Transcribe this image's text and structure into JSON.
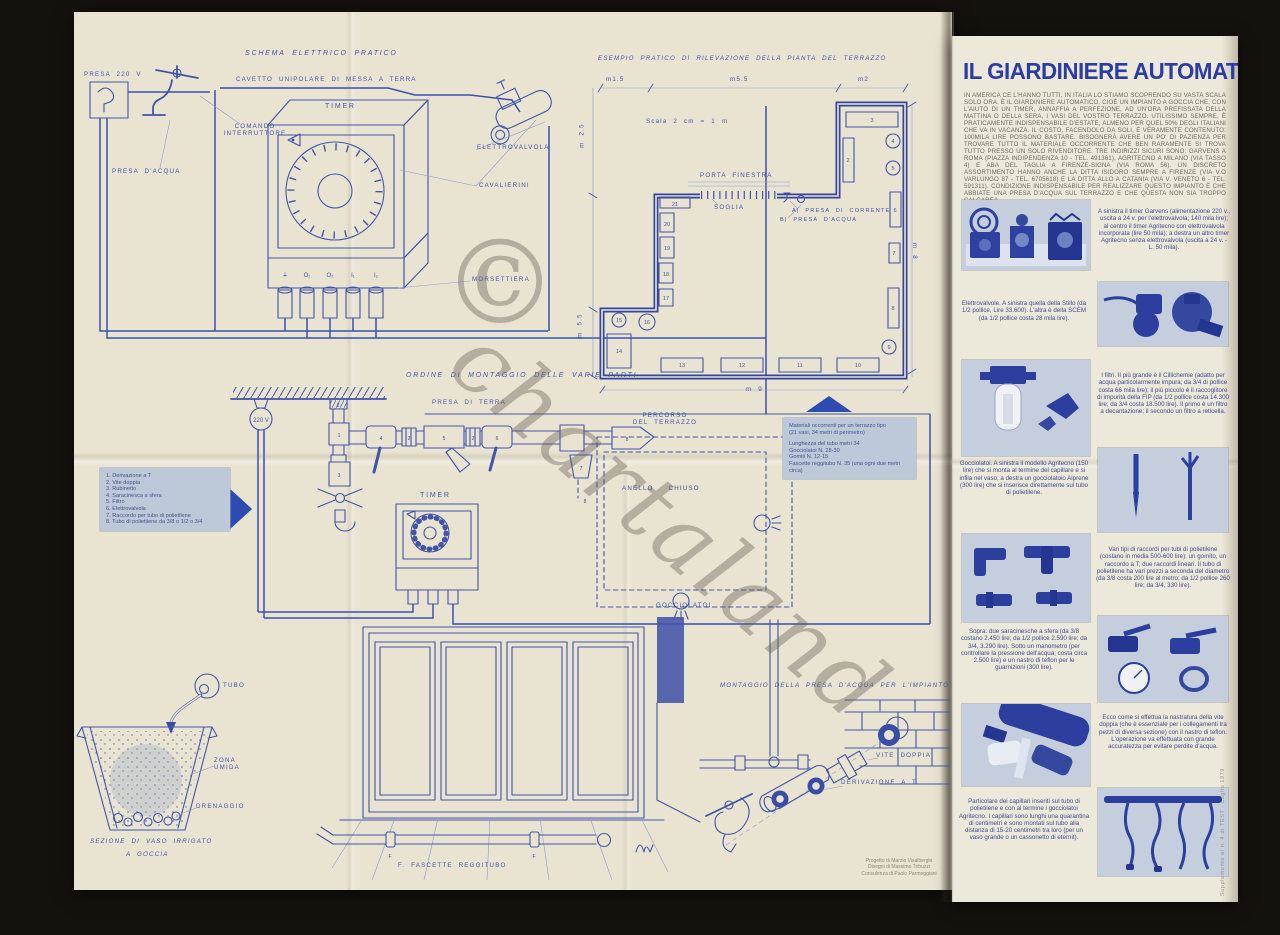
{
  "colors": {
    "ink": "#4254a8",
    "ink_dark": "#2b3da5",
    "paper": "#e9e4d2",
    "paper_right": "#ece8da",
    "photo_bg": "#c5cedd",
    "box_bg": "#bdc9d9"
  },
  "watermark": {
    "symbol": "©",
    "text": "chartaland"
  },
  "edge_note": "Supplemento al n. 4 di TEST - Luglio 1979",
  "credits": {
    "line1": "Progetto di Marzio Visalberghi",
    "line2": "Disegni di Massimo Tribuzzi",
    "line3": "Consulenza di Paolo Parmeggiani"
  },
  "schema": {
    "title": "SCHEMA ELETTRICO PRATICO",
    "presa_220": "PRESA 220 V",
    "cavetto": "CAVETTO UNIPOLARE DI MESSA A TERRA",
    "timer": "TIMER",
    "comando_1": "COMANDO",
    "comando_2": "INTERRUTTORE",
    "presa_acqua": "PRESA D'ACQUA",
    "elettrovalvola": "ELETTROVALVOLA",
    "cavalierini": "CAVALIERINI",
    "morsettiera": "MORSETTIERA",
    "terminals": [
      "⏚",
      "O₁",
      "O₂",
      "I₁",
      "I₂"
    ]
  },
  "pianta": {
    "title": "ESEMPIO PRATICO DI RILEVAZIONE DELLA PIANTA DEL TERRAZZO",
    "scala": "Scala  2 cm = 1 m",
    "porta_finestra": "PORTA FINESTRA",
    "soglia": "SOGLIA",
    "presa_corrente": "A| PRESA DI CORRENTE",
    "presa_acqua": "B| PRESA D'ACQUA",
    "dim_top_1": "m1.5",
    "dim_top_2": "m5.5",
    "dim_top_3": "m2",
    "dim_left_1": "m 2.5",
    "dim_left_2": "m 5.5",
    "dim_right": "m 8",
    "dim_bottom": "m 9",
    "vases": [
      "2",
      "3",
      "4",
      "5",
      "6",
      "7",
      "8",
      "9",
      "10",
      "11",
      "12",
      "13",
      "14",
      "15",
      "16",
      "17",
      "18",
      "19",
      "20",
      "21"
    ]
  },
  "montaggio": {
    "title": "ORDINE DI MONTAGGIO DELLE VARIE PARTI",
    "lamp": "220 V",
    "presa_terra": "PRESA DI TERRA",
    "timer": "TIMER",
    "percorso_1": "PERCORSO",
    "percorso_2": "DEL TERRAZZO",
    "anello": "ANELLO   CHIUSO",
    "gocciolatoi": "GOCCIOLATOI",
    "part_numbers": [
      "1",
      "2",
      "3",
      "4",
      "5",
      "6",
      "7",
      "8"
    ],
    "legend": [
      "1.  Derivazione a T",
      "2.  Vite doppia",
      "3.  Rubinetto",
      "4.  Saracinesca a sfera",
      "5.  Filtro",
      "6.  Elettrovalvola",
      "7.  Raccordo per tubo di polietilene",
      "8.  Tubo di polietilene da 3/8 o 1/2 o 3/4"
    ],
    "materiali_1": "Materiali occorrenti per un terrazzo tipo",
    "materiali_2": "(21 vasi, 34 metri di perimetro)",
    "materiali_items": [
      "Lunghezza del tubo metri 34",
      "Gocciolatoi N. 28-30",
      "Gomiti N. 12-15",
      "Fascette reggitubo N. 35 (una ogni due metri circa)"
    ]
  },
  "vaso": {
    "tubo": "TUBO",
    "zona_1": "ZONA",
    "zona_2": "UMIDA",
    "drenaggio": "DRENAGGIO",
    "caption_1": "SEZIONE DI VASO IRRIGATO",
    "caption_2": "A  GOCCIA"
  },
  "fascette_label": "F. FASCETTE  REGGITUBO",
  "fascetta_f": "F",
  "presa_impianto": {
    "title": "MONTAGGIO DELLA PRESA D'ACQUA PER L'IMPIANTO",
    "vite_doppia": "VITE DOPPIA",
    "derivazione": "DERIVAZIONE A T"
  },
  "article": {
    "title": "IL GIARDINIERE AUTOMATICO",
    "intro": "IN AMERICA CE L'HANNO TUTTI, IN ITALIA LO STIAMO SCOPRENDO SU VASTA SCALA SOLO ORA. È IL GIARDINIERE AUTOMATICO, CIOÈ UN IMPIANTO A GOCCIA CHE, CON L'AIUTO DI UN TIMER, ANNAFFIA A PERFEZIONE, AD UN'ORA PREFISSATA DELLA MATTINA O DELLA SERA, I VASI DEL VOSTRO TERRAZZO. UTILISSIMO SEMPRE, È PRATICAMENTE INDISPENSABILE D'ESTATE, ALMENO PER QUEL 50% DEGLI ITALIANI CHE VA IN VACANZA. IL COSTO, FACENDOLO DA SOLI, È VERAMENTE CONTENUTO: 100MILA LIRE POSSONO BASTARE. BISOGNERÀ AVERE UN PO' DI PAZIENZA PER TROVARE TUTTO IL MATERIALE OCCORRENTE CHE BEN RARAMENTE SI TROVA TUTTO PRESSO UN SOLO RIVENDITORE. TRE INDIRIZZI SICURI SONO: GARVENS A ROMA (PIAZZA INDIPENDENZA 10 - TEL. 491361), AGRITECNO A MILANO (VIA TASSO 4) E ABA DEL TAGLIA A FIRENZE-SIGNA (VIA ROMA 56). UN DISCRETO ASSORTIMENTO HANNO ANCHE LA DITTA ISIDORO SEMPRE A FIRENZE (VIA V.O VARLUNGO 87 - TEL. 6705618) E LA DITTA ALLO A CATANIA (VIA V. VENETO 6 - TEL. 591311). CONDIZIONE INDISPENSABILE PER REALIZZARE QUESTO IMPIANTO È CHE ABBIATE UNA PRESA D'ACQUA SUL TERRAZZO E CHE QUESTA NON SIA TROPPO CALCAREA.",
    "captions": [
      "A sinistra il timer Garvens (alimentazione 220 v., uscita a 24 v. per l'elettrovalvola; 140 mila lire); al centro il timer Agritecno con elettrovalvola incorporata (lire 50 mila); a destra un altro timer Agritecno senza elettrovalvola (uscita a 24 v. - L. 50 mila).",
      "Elettrovalvole. A sinistra quella della Stillo (da 1/2 pollice, Lire 33.600). L'altra è della SCEM (da 1/2 pollice costa 28 mila lire).",
      "I filtri. Il più grande è il Cillichemie (adatto per acqua particolarmente impura; da 3/4 di pollice costa 66 mila lire); il più piccolo è il raccoglitore di impurità della FIP (da 1/2 pollice costa 14.300 lire; da 3/4 costa 18.500 lire). Il primo è un filtro a decantazione; il secondo un filtro a reticella.",
      "Gocciolatoi. A sinistra il modello Agritecno (150 lire) che si monta al termine del capillare e si infila nel vaso; a destra un gocciolatoio Alprene (300 lire) che si inserisce direttamente sul tubo di polietilene.",
      "Vari tipi di raccordi per tubi di polietilene (costano in media 500-600 lire): un gomito, un raccordo a T; due raccordi lineari. Il tubo di polietilene ha vari prezzi a seconda del diametro (da 3/8 costa 200 lire al metro; da 1/2 pollice 260 lire; da 3/4, 330 lire).",
      "Sopra: due saracinesche a sfera (da 3/8 costano 2.450 lire; da 1/2 pollice 2.590 lire; da 3/4, 3.290 lire). Sotto un manometro (per controllare la pressione dell'acqua; costa circa 2.500 lire) e un nastro di teflon per le guarnizioni (300 lire).",
      "Ecco come si effettua la nastratura della vite doppia (che è essenziale per i collegamenti tra pezzi di diversa sezione) con il nastro di teflon. L'operazione va effettuata con grande accuratezza per evitare perdite d'acqua.",
      "Particolare dei capillari inseriti sul tubo di polietilene e con al termine i gocciolatoi Agritecno. I capillari sono lunghi una quarantina di centimetri e sono montati sul tubo alla distanza di 15-20 centimetri tra loro (per un vaso grande o un cassonetto di eternit)."
    ]
  }
}
